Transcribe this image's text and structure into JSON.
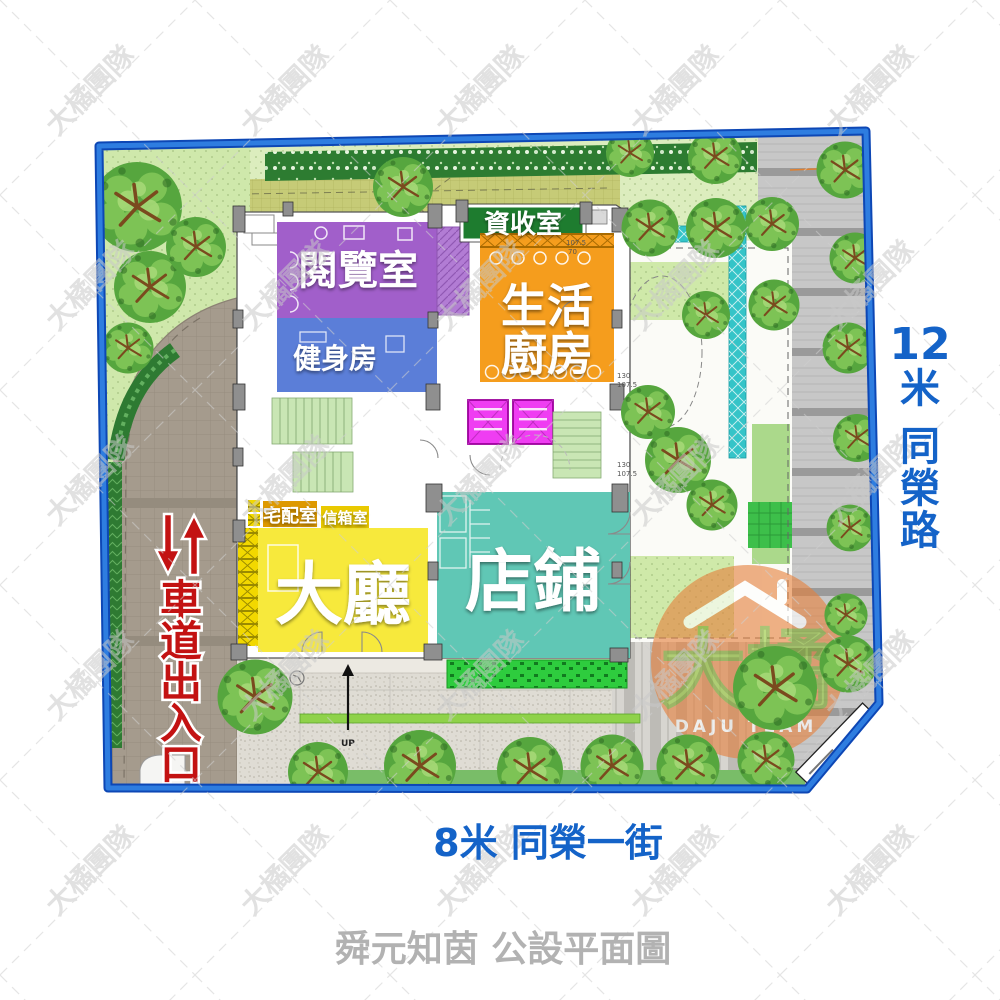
{
  "title": "舜元知茵 公設平面圖",
  "plan": {
    "rooms": {
      "reading": "閱覽室",
      "gym": "健身房",
      "recycle": "資收室",
      "kitchen_line1": "生活",
      "kitchen_line2": "廚房",
      "delivery": "宅配室",
      "mailbox": "信箱室",
      "lobby": "大廳",
      "shop": "店鋪"
    },
    "driveway_label": {
      "chars": [
        "車",
        "道",
        "出",
        "入",
        "口"
      ]
    },
    "up_label": "UP",
    "dims": [
      "107.5",
      "70",
      "130",
      "107.5",
      "130",
      "107.5"
    ]
  },
  "roads": {
    "right": {
      "width": "12",
      "unit": "米",
      "name_chars": [
        "同",
        "榮",
        "路"
      ]
    },
    "bottom": "8米 同榮一街"
  },
  "watermark": {
    "tile_text": "大橘團隊",
    "logo_cn": "大橘",
    "logo_en": "DAJU TEAM"
  },
  "colors": {
    "border_blue": "#1f5fd0",
    "road_text_blue": "#1463c8",
    "driveway_text_red": "#c31212",
    "reading_purple": "#a15fca",
    "gym_blue": "#5b7ed8",
    "recycle_green": "#1e7c2f",
    "kitchen_orange": "#f59d1d",
    "delivery_amber": "#de9900",
    "mailbox_yellow": "#e9c900",
    "lobby_yellow": "#f7e93c",
    "shop_teal": "#60c7b5",
    "elevator_magenta": "#ef3df2",
    "title_gray": "#b2b2b2"
  }
}
